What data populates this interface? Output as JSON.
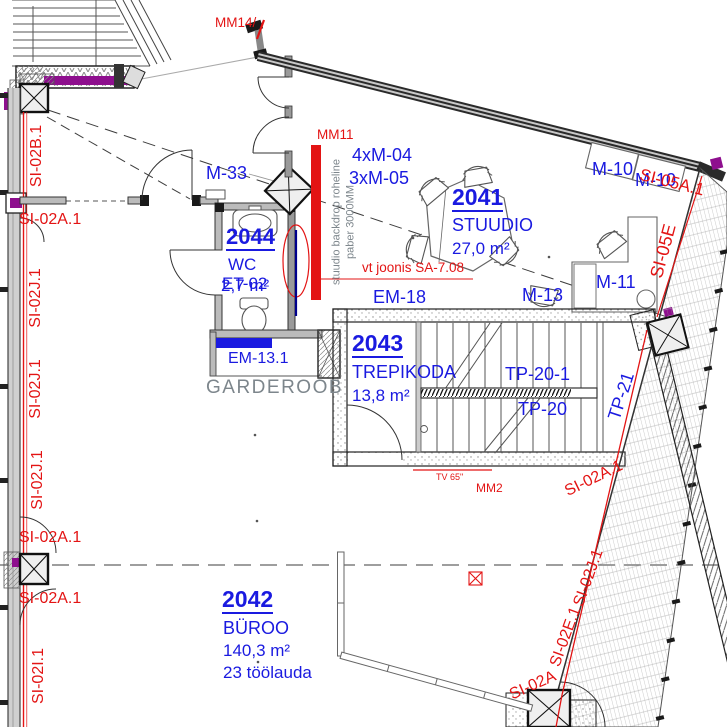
{
  "colors": {
    "label_blue": "#1a1ae0",
    "marking_red": "#e31414",
    "text_grey": "#7d868c",
    "accent_purple": "#8e0f8e",
    "backdrop_navy": "#00008b"
  },
  "rooms": {
    "studio": {
      "number": "2041",
      "name": "STUUDIO",
      "area": "27,0 m²"
    },
    "office": {
      "number": "2042",
      "name": "BÜROO",
      "area": "140,3 m²",
      "desks": "23 töölauda"
    },
    "stairwell": {
      "number": "2043",
      "name": "TREPIKODA",
      "area": "13,8 m²"
    },
    "wc": {
      "number": "2044",
      "name": "WC",
      "area": "2,7 m²",
      "code": "ET-02"
    }
  },
  "furniture_labels": {
    "m33": "M-33",
    "m10_upper": "M-10",
    "m10_lower": "M-10",
    "m11": "M-11",
    "m13": "M-13",
    "m04_group": "4xM-04",
    "m05_group": "3xM-05",
    "em18": "EM-18",
    "em13_1": "EM-13.1",
    "garderoob": "GARDEROOB",
    "tv": "TV 65\"",
    "tp20_1": "TP-20-1",
    "tp20": "TP-20",
    "tp21": "TP-21"
  },
  "markings": {
    "mm14": "MM14/",
    "mm11": "MM11",
    "mm2": "MM2",
    "reference_note": "vt joonis SA-7.08",
    "backdrop_note_line1": "stuudio backdrop roheline",
    "backdrop_note_line2": "paber 3000MM"
  },
  "fire_safety": {
    "left": {
      "si02b1": "SI-02B.1",
      "si02a1_top": "SI-02A.1",
      "si02j1_a": "SI-02J.1",
      "si02j1_b": "SI-02J.1",
      "si02j1_c": "SI-02J.1",
      "si02a1_mid": "SI-02A.1",
      "si02a1_low": "SI-02A.1",
      "si02i1": "SI-02I.1"
    },
    "right": {
      "si05a1": "SI-05A.1",
      "si05e": "SI-05E",
      "si02a1": "SI-02A.1",
      "si02j1": "SI-02J.1",
      "si02e1": "SI-02E.1",
      "si02a": "SI-02A"
    }
  }
}
